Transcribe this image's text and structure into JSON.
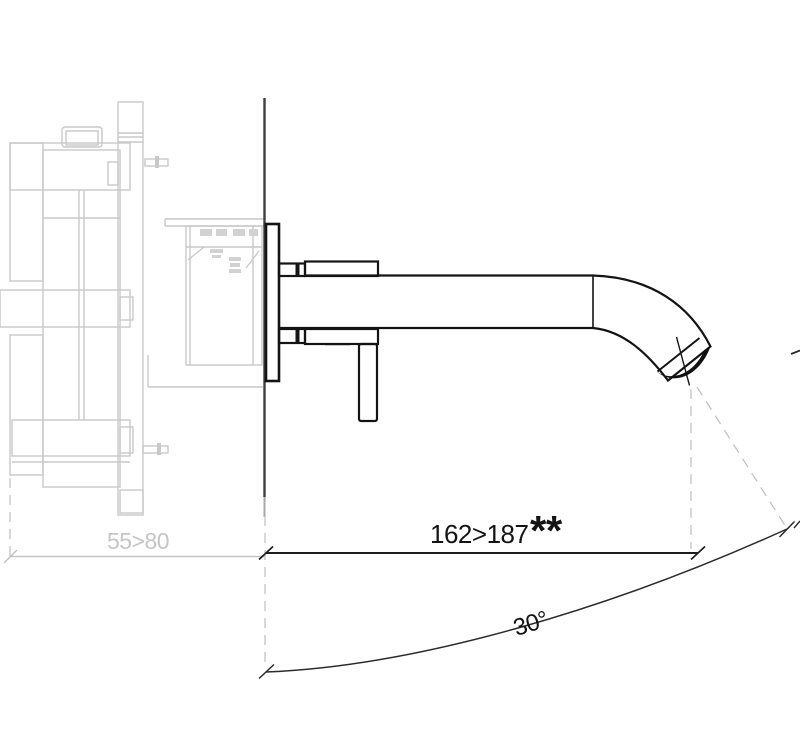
{
  "title": "Wall-mounted single-lever mixer — side elevation technical drawing",
  "dimensions": {
    "projection": {
      "value": "162>187",
      "suffix": "**"
    },
    "depth": {
      "value": "55>80"
    },
    "angle": {
      "value": "30°"
    }
  },
  "colors": {
    "fixture_dark": "#141414",
    "valve_gray": "#c9c9c9",
    "wall_line": "#3f3f3f",
    "dashed_gray": "#c2c2c2",
    "dim_dark": "#1d1d1d",
    "dim_gray": "#c5c5c5",
    "background": "#ffffff"
  }
}
